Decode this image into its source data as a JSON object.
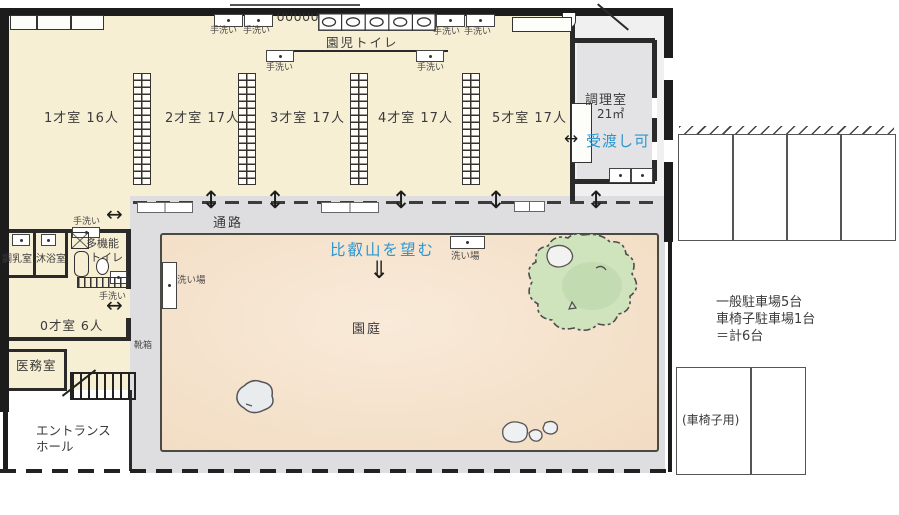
{
  "rooms": {
    "age1": "1才室 16人",
    "age2": "2才室 17人",
    "age3": "3才室 17人",
    "age4": "4才室 17人",
    "age5": "5才室 17人",
    "age0": "0才室 6人",
    "kitchen": "調理室",
    "kitchen_area": "21㎡",
    "kids_toilet": "園児トイレ",
    "multi_toilet_l1": "多機能",
    "multi_toilet_l2": "トイレ",
    "milk": "調乳室",
    "bath": "沐浴室",
    "medical": "医務室",
    "entrance_l1": "エントランス",
    "entrance_l2": "ホール",
    "corridor": "通路",
    "yard": "園庭"
  },
  "labels": {
    "hand_wash": "手洗い",
    "wash_station": "洗い場",
    "shoe_box": "靴箱",
    "handover": "受渡し可",
    "view_note": "比叡山を望む"
  },
  "parking": {
    "general": "一般駐車場5台",
    "wheelchair_count": "車椅子駐車場1台",
    "total": "＝計6台",
    "wheelchair_stall": "(車椅子用)"
  },
  "icons": {
    "door_arrow_v": "↕",
    "door_arrow_h": "↔",
    "handover_arrow": "↔",
    "view_arrow": "⇓",
    "urinal_row": "∪∪∪∪∪"
  },
  "colors": {
    "room_cream": "#f7efd4",
    "yard_sand": "#f5e2cc",
    "concrete": "#dedee0",
    "kitchen_gray": "#e3e3e6",
    "tree_green": "#cfe3bd",
    "accent_blue": "#2d96cf",
    "wall": "#1c1c1c"
  }
}
